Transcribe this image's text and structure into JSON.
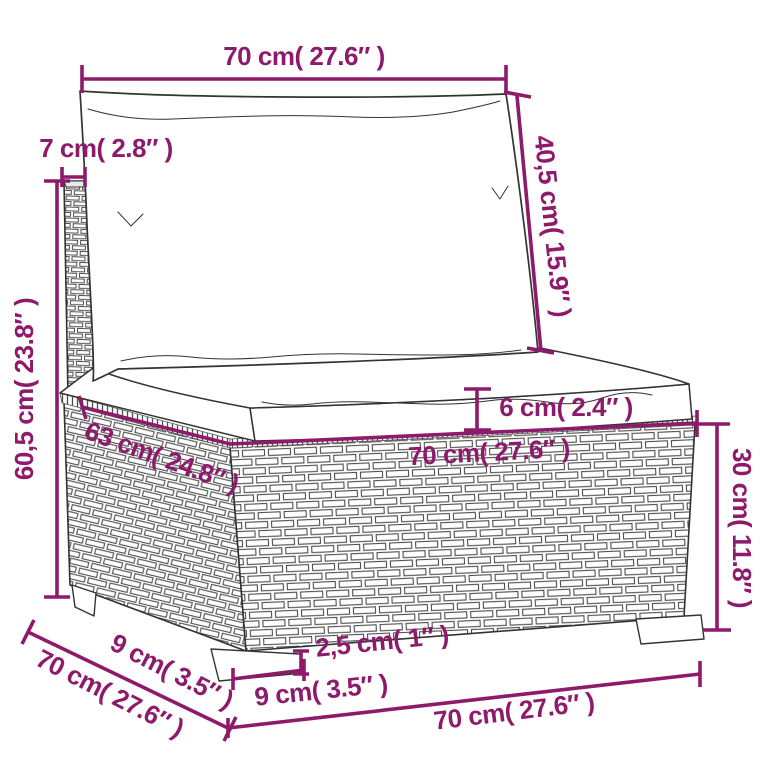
{
  "figure": {
    "kind": "furniture-dimension-diagram",
    "subject": "rattan-sofa-section-with-cushions",
    "accent_color": "#8E1A6B",
    "line_color": "#333333",
    "background_color": "#FFFFFF"
  },
  "labels": {
    "back_cushion_width": "70 cm( 27.6″ )",
    "back_thickness": "7 cm( 2.8″ )",
    "back_cushion_diagonal": "40,5 cm( 15.9″ )",
    "back_total_height": "60,5 cm( 23.8″ )",
    "seat_cushion_thickness": "6 cm( 2.4″ )",
    "seat_diagonal_depth": "63 cm( 24.8″ )",
    "seat_top_width": "70 cm( 27.6″ )",
    "base_height": "30 cm( 11.8″ )",
    "bottom_leg_inset": "9 cm( 3.5″ )",
    "bottom_depth": "70 cm( 27.6″ )",
    "leg_width": "9 cm( 3.5″ )",
    "leg_height": "2,5 cm( 1″ )",
    "bottom_front_width": "70 cm( 27.6″ )"
  }
}
